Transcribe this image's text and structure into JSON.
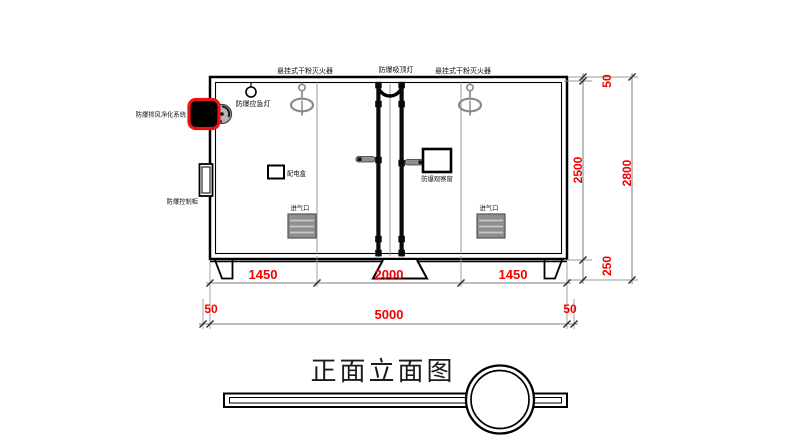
{
  "title": "正面立面图",
  "colors": {
    "dimension_red": "#f40000",
    "highlight_red": "#ee1111",
    "line_black": "#000000",
    "equipment_gray": "#8a8a8a"
  },
  "labels": {
    "left_sprinkler": "悬挂式干粉灭火器",
    "right_sprinkler": "悬挂式干粉灭火器",
    "ceiling_light": "防爆吸顶灯",
    "emergency_light": "防爆应急灯",
    "purification_system": "防爆排风净化系统",
    "control_cabinet": "防爆控制柜",
    "distribution_box": "配电盒",
    "observation_window": "防爆观察窗",
    "air_inlet_left": "进气口",
    "air_inlet_right": "进气口"
  },
  "dimensions": {
    "bottom_chain": {
      "seg1": "1450",
      "seg2": "2000",
      "seg3": "1450"
    },
    "outer_chain": {
      "left": "50",
      "total": "5000",
      "right": "50"
    },
    "right_chain": {
      "top": "50",
      "inner": "2500",
      "base": "250",
      "total": "2800"
    }
  }
}
